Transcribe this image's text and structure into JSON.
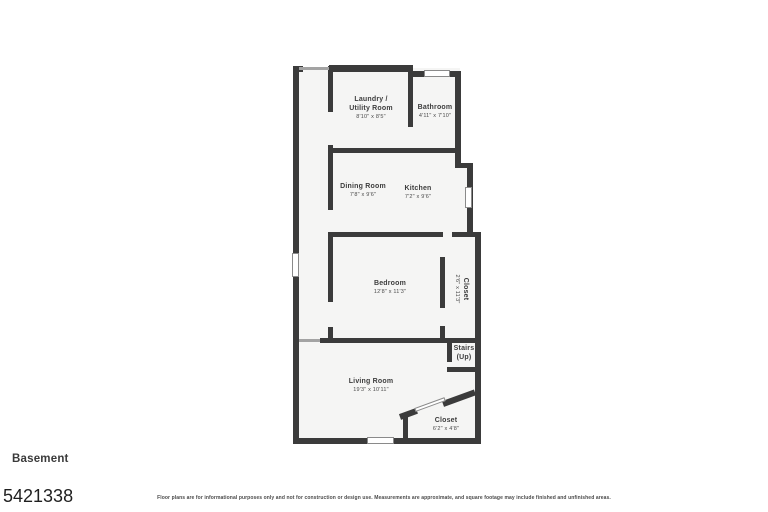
{
  "floor_plan": {
    "level_label": "Basement",
    "listing_number": "5421338",
    "disclaimer": "Floor plans are for informational purposes only and not for construction or design use. Measurements are approximate, and square footage may include finished and unfinished areas.",
    "colors": {
      "wall": "#3b3b3b",
      "floor": "#f5f5f4",
      "window_frame": "#8a8a8a",
      "label_text": "#3d3d3d",
      "background": "#ffffff"
    },
    "rooms": [
      {
        "name": "Laundry /\nUtility Room",
        "dimensions": "8'10\" x 8'5\""
      },
      {
        "name": "Bathroom",
        "dimensions": "4'11\" x 7'10\""
      },
      {
        "name": "Dining Room",
        "dimensions": "7'8\" x 9'6\""
      },
      {
        "name": "Kitchen",
        "dimensions": "7'2\" x 9'6\""
      },
      {
        "name": "Bedroom",
        "dimensions": "12'8\" x 11'3\""
      },
      {
        "name": "Closet",
        "dimensions": "2'6\" x 11'3\""
      },
      {
        "name": "Stairs\n(Up)",
        "dimensions": ""
      },
      {
        "name": "Living Room",
        "dimensions": "19'3\" x 10'11\""
      },
      {
        "name": "Closet",
        "dimensions": "6'2\" x 4'8\""
      }
    ]
  }
}
